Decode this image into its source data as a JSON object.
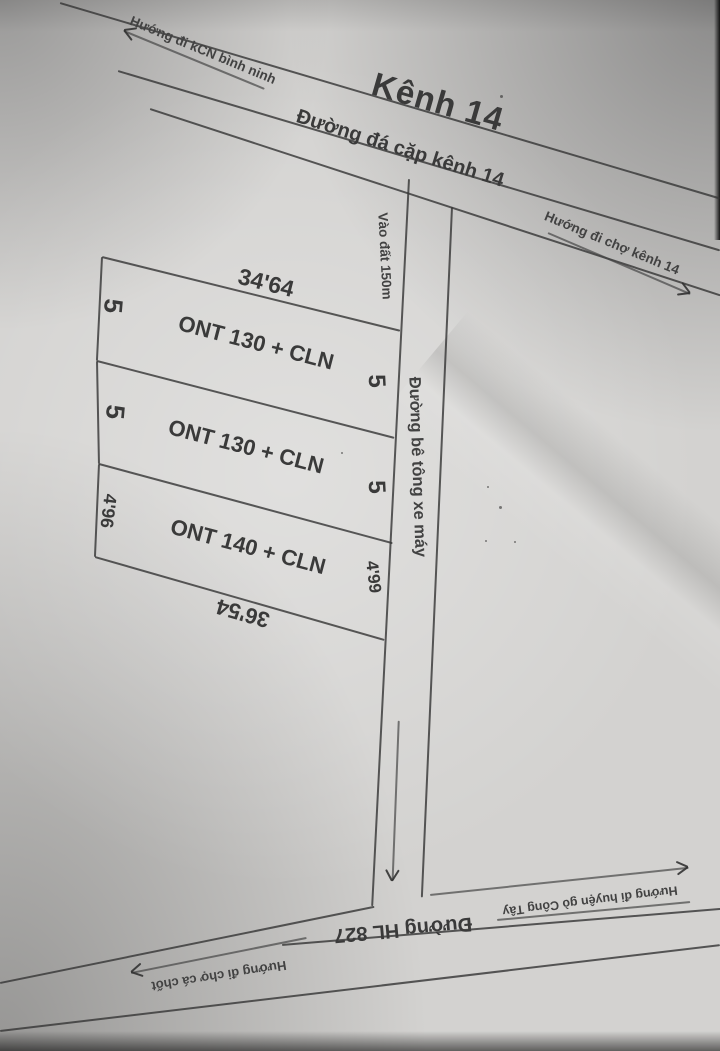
{
  "sketch": {
    "ink_color": "#3a3a3a",
    "paper_color": "#d3d2d0",
    "canal": {
      "title": "Kênh 14",
      "road_label": "Đường đá cặp kênh 14",
      "direction_nw": "Hướng đi kCN bình ninh",
      "direction_se": "Hướng đi chợ kênh 14"
    },
    "access_road": {
      "entry_label": "Vào đất 150m",
      "road_label": "Đường bê tông xe máy"
    },
    "plots": [
      {
        "label": "ONT 130 + CLN",
        "top_dim": "34'64",
        "left_dim": "5",
        "right_dim": "5"
      },
      {
        "label": "ONT 130 + CLN",
        "left_dim": "5",
        "right_dim": "5"
      },
      {
        "label": "ONT 140 + CLN",
        "left_dim": "4'96",
        "right_dim": "4'99",
        "bottom_dim": "36'54"
      }
    ],
    "bottom_road": {
      "label": "Đường HL 827",
      "direction_sw": "Hướng đi chợ cá chốt",
      "direction_se": "Hướng đi huyện gò Công Tây"
    }
  }
}
